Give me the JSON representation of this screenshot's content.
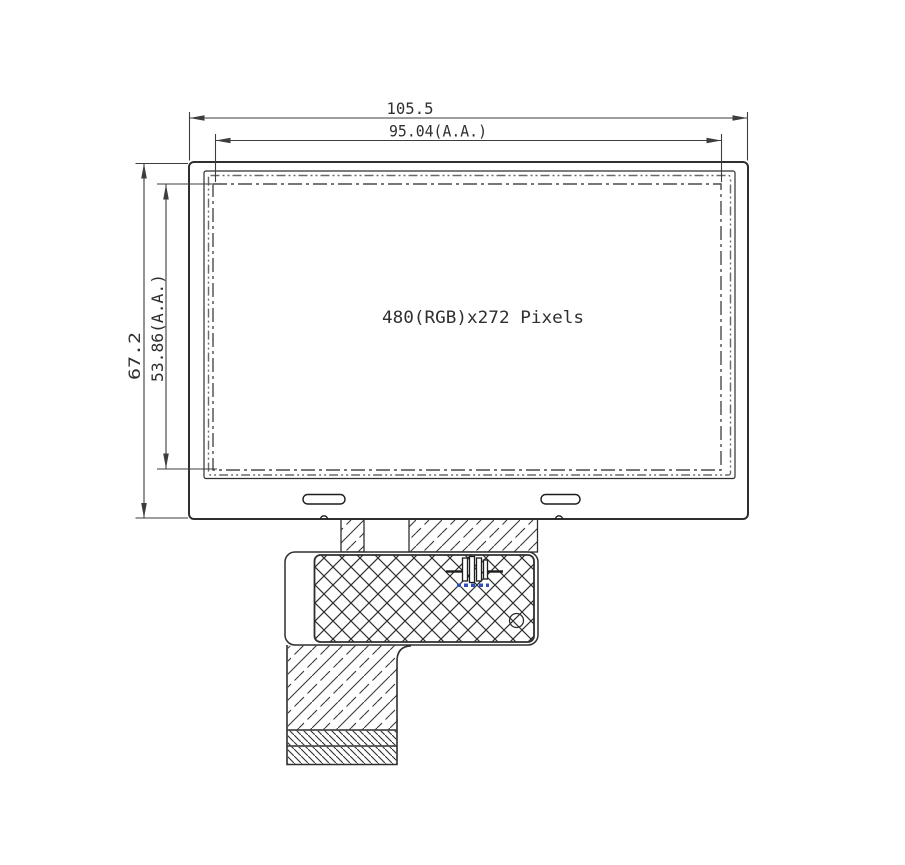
{
  "labels": {
    "outline_width": "105.5",
    "active_area_width": "95.04(A.A.)",
    "outline_height": "67.2",
    "active_area_height": "53.86(A.A.)",
    "resolution": "480(RGB)x272 Pixels"
  },
  "colors": {
    "background": "#ffffff",
    "outline_line": "#2f2f2f",
    "dimension_line": "#3d3d3d",
    "hatch_line": "#3a3a3a",
    "component_marking": "#2f4fbf"
  }
}
